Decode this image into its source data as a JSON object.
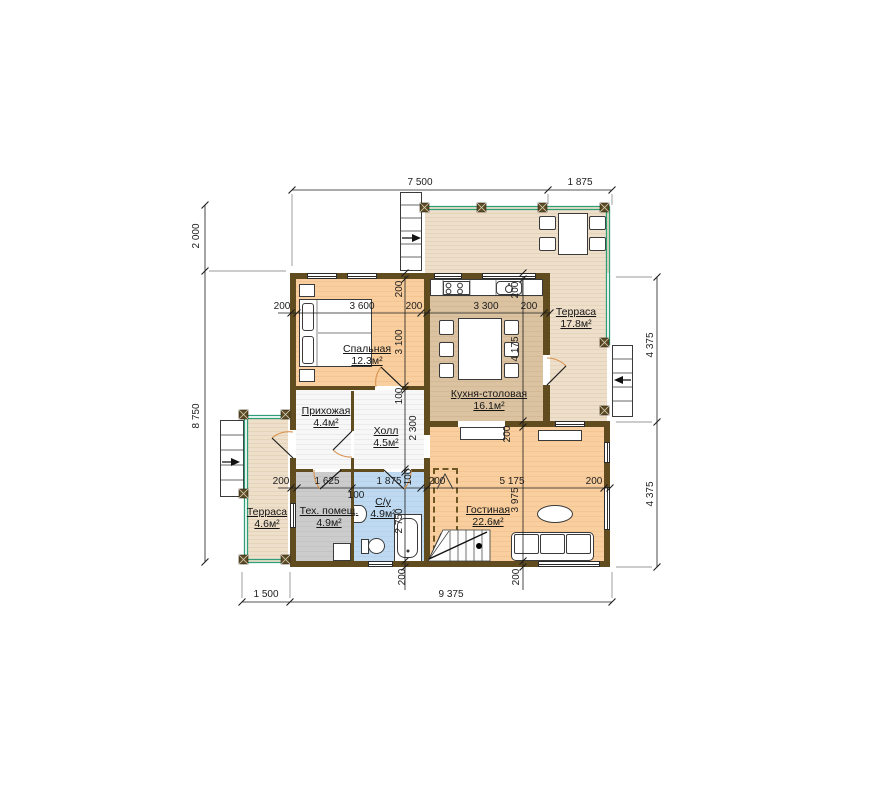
{
  "rooms": {
    "bedroom": {
      "name": "Спальная",
      "area": "12.3м²"
    },
    "entry_hall": {
      "name": "Прихожая",
      "area": "4.4м²"
    },
    "hall": {
      "name": "Холл",
      "area": "4.5м²"
    },
    "kitchen": {
      "name": "Кухня-столовая",
      "area": "16.1м²"
    },
    "terrace_top": {
      "name": "Терраса",
      "area": "17.8м²"
    },
    "terrace_left": {
      "name": "Терраса",
      "area": "4.6м²"
    },
    "tech": {
      "name": "Тех. помещ.",
      "area": "4.9м²"
    },
    "wc": {
      "name": "С/у",
      "area": "4.9м²"
    },
    "living": {
      "name": "Гостиная",
      "area": "22.6м²"
    }
  },
  "dims": {
    "top": [
      "7 500",
      "1 875"
    ],
    "left": [
      "2 000",
      "8 750"
    ],
    "right": [
      "4 375",
      "4 375"
    ],
    "bottom": [
      "1 500",
      "9 375"
    ],
    "row_upper": [
      "200",
      "3 600",
      "200",
      "3 300",
      "200"
    ],
    "row_lower": [
      "200",
      "1 625",
      "1 875",
      "200",
      "5 175",
      "200"
    ],
    "row_lower_wall": "100",
    "col_left": [
      "200",
      "3 100",
      "100",
      "2 300",
      "100",
      "2 750",
      "200"
    ],
    "col_right": [
      "200",
      "4 175",
      "200",
      "3 975",
      "200"
    ]
  },
  "colors": {
    "wall": "#604c1f",
    "railing": "#2f9e78",
    "floor_rooms": "#f9cf9f",
    "floor_kitchen": "#dbc3a1",
    "floor_terrace": "#eedfca",
    "floor_wc": "#bfdaf0",
    "floor_tech": "#cccccc",
    "door_arc": "#d8934e"
  }
}
